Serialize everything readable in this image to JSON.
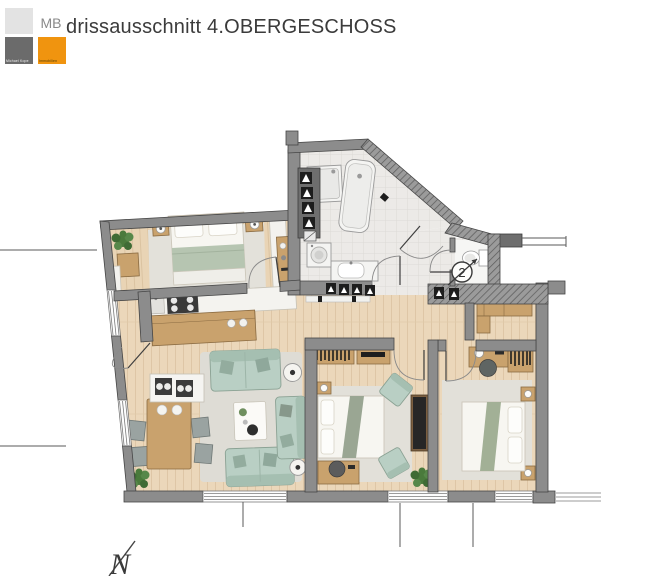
{
  "header": {
    "title": "drissausschnitt 4.OBERGESCHOSS",
    "logo": {
      "initials": "MB",
      "company_line1": "Michael Kope",
      "company_line2": "Immobilien"
    }
  },
  "plan": {
    "entrance_badge": "2",
    "north_label": "N",
    "rooms": [
      "bedroom",
      "bathroom",
      "wc",
      "entry-hall",
      "living-dining-kitchen",
      "bedroom-2",
      "bedroom-3",
      "wardrobe-nook"
    ],
    "fixtures": [
      "double-bed",
      "nightstand",
      "plant",
      "wardrobe",
      "kitchen-counter",
      "cooktop",
      "kitchen-island",
      "dining-table",
      "chair",
      "sofa",
      "chaise",
      "coffee-table",
      "floor-lamp",
      "bathtub",
      "shower",
      "washbasin",
      "washing-machine",
      "toilet",
      "desk",
      "bookshelf",
      "office-chair"
    ]
  },
  "colors": {
    "logo_orange": "#F0940F",
    "logo_dark_gray": "#6B6B6B",
    "logo_light_gray": "#E3E3E3",
    "logo_mb_gray": "#8A8A8A",
    "wall_gray": "#8C8C8C",
    "wall_outline": "#454545",
    "wood_floor": "#EBD7BA",
    "tile_floor": "#ECEAE7",
    "rug": "#E0DED7",
    "sofa_green": "#B9CFC4",
    "furniture_wood": "#C9A26D",
    "bed_white": "#F7F6F1",
    "title_text": "#3B3B3B"
  }
}
